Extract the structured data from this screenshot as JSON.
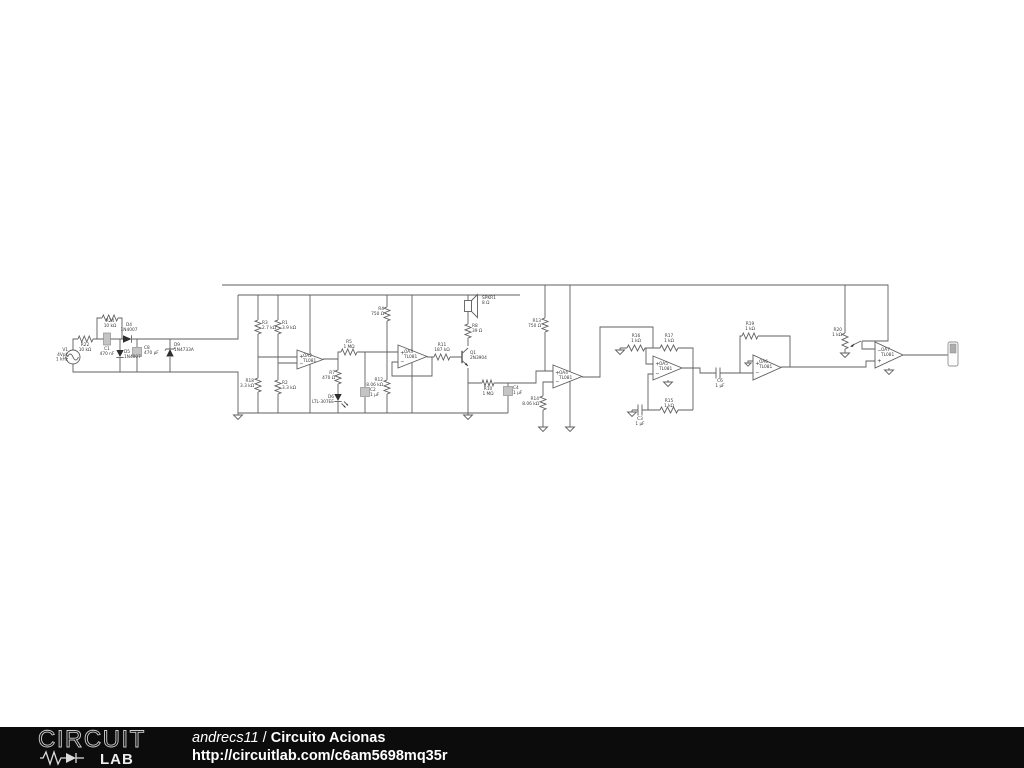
{
  "footer": {
    "logo_word1": "CIRCUIT",
    "logo_word2": "LAB",
    "user": "andrecs11",
    "separator": " / ",
    "title": "Circuito Acionas",
    "url": "http://circuitlab.com/c6am5698mq35r",
    "bar_color": "#0c0c0c",
    "text_color": "#ffffff"
  },
  "schematic": {
    "colors": {
      "wire": "#5f5f5f",
      "dark": "#2e2e2e",
      "ecap_fill": "#c4c4c4",
      "ecap_stroke": "#8f8f8f",
      "label": "#3a3a3a"
    },
    "labels": [
      {
        "name": "V1",
        "x": 68,
        "y": 351,
        "anchor": "end",
        "lines": [
          "V1",
          "4Vpk",
          "1 kHz"
        ]
      },
      {
        "name": "R22",
        "x": 85,
        "y": 346,
        "anchor": "middle",
        "lines": [
          "R22",
          "10 kΩ"
        ]
      },
      {
        "name": "R24",
        "x": 110,
        "y": 322,
        "anchor": "middle",
        "lines": [
          "R24",
          "10 kΩ"
        ]
      },
      {
        "name": "C1",
        "x": 107,
        "y": 350,
        "anchor": "middle",
        "lines": [
          "C1",
          "470 nF"
        ]
      },
      {
        "name": "D4",
        "x": 129,
        "y": 326,
        "anchor": "middle",
        "lines": [
          "D4",
          "1N4007"
        ]
      },
      {
        "name": "D5",
        "x": 124,
        "y": 353,
        "anchor": "start",
        "lines": [
          "D5",
          "1N4007"
        ]
      },
      {
        "name": "C8",
        "x": 144,
        "y": 349,
        "anchor": "start",
        "lines": [
          "C8",
          "470 µF"
        ]
      },
      {
        "name": "D9",
        "x": 174,
        "y": 346,
        "anchor": "start",
        "lines": [
          "D9",
          "1N4733A"
        ]
      },
      {
        "name": "R3",
        "x": 262,
        "y": 324,
        "anchor": "start",
        "lines": [
          "R3",
          "2.7 kΩ"
        ]
      },
      {
        "name": "R18",
        "x": 254,
        "y": 382,
        "anchor": "end",
        "lines": [
          "R18",
          "3.3 kΩ"
        ]
      },
      {
        "name": "R1",
        "x": 282,
        "y": 324,
        "anchor": "start",
        "lines": [
          "R1",
          "3.9 kΩ"
        ]
      },
      {
        "name": "R2",
        "x": 282,
        "y": 384,
        "anchor": "start",
        "lines": [
          "R2",
          "3.3 kΩ"
        ]
      },
      {
        "name": "OA2",
        "x": 303,
        "y": 357,
        "anchor": "start",
        "lines": [
          "OA2",
          "TL081"
        ]
      },
      {
        "name": "R5",
        "x": 349,
        "y": 343,
        "anchor": "middle",
        "lines": [
          "R5",
          "1 MΩ"
        ]
      },
      {
        "name": "R7",
        "x": 335,
        "y": 374,
        "anchor": "end",
        "lines": [
          "R7",
          "470 Ω"
        ]
      },
      {
        "name": "D6",
        "x": 334,
        "y": 398,
        "anchor": "end",
        "lines": [
          "D6",
          "LTL-307EE"
        ]
      },
      {
        "name": "R4",
        "x": 384,
        "y": 310,
        "anchor": "end",
        "lines": [
          "R4",
          "750 Ω"
        ]
      },
      {
        "name": "C2",
        "x": 370,
        "y": 391,
        "anchor": "start",
        "lines": [
          "C2",
          "1 µF"
        ]
      },
      {
        "name": "R12",
        "x": 383,
        "y": 381,
        "anchor": "end",
        "lines": [
          "R12",
          "8.06 kΩ"
        ]
      },
      {
        "name": "OA3",
        "x": 404,
        "y": 353,
        "anchor": "start",
        "lines": [
          "OA3",
          "TL081"
        ]
      },
      {
        "name": "R11",
        "x": 442,
        "y": 346,
        "anchor": "middle",
        "lines": [
          "R11",
          "187 kΩ"
        ]
      },
      {
        "name": "Q1",
        "x": 470,
        "y": 354,
        "anchor": "start",
        "lines": [
          "Q1",
          "2N3904"
        ]
      },
      {
        "name": "R8",
        "x": 472,
        "y": 327,
        "anchor": "start",
        "lines": [
          "R8",
          "39 Ω"
        ]
      },
      {
        "name": "SPKR1",
        "x": 482,
        "y": 299,
        "anchor": "start",
        "lines": [
          "SPKR1",
          "8 Ω"
        ]
      },
      {
        "name": "R10",
        "x": 488,
        "y": 390,
        "anchor": "middle",
        "lines": [
          "R10",
          "1 MΩ"
        ]
      },
      {
        "name": "C4",
        "x": 513,
        "y": 389,
        "anchor": "start",
        "lines": [
          "C4",
          "1 µF"
        ]
      },
      {
        "name": "R13",
        "x": 541,
        "y": 322,
        "anchor": "end",
        "lines": [
          "R13",
          "750 Ω"
        ]
      },
      {
        "name": "R14",
        "x": 539,
        "y": 400,
        "anchor": "end",
        "lines": [
          "R14",
          "8.06 kΩ"
        ]
      },
      {
        "name": "OA4",
        "x": 559,
        "y": 374,
        "anchor": "start",
        "lines": [
          "OA4",
          "TL081"
        ]
      },
      {
        "name": "R16",
        "x": 636,
        "y": 337,
        "anchor": "middle",
        "lines": [
          "R16",
          "1 kΩ"
        ]
      },
      {
        "name": "R17",
        "x": 669,
        "y": 337,
        "anchor": "middle",
        "lines": [
          "R17",
          "1 kΩ"
        ]
      },
      {
        "name": "OA5",
        "x": 659,
        "y": 365,
        "anchor": "start",
        "lines": [
          "OA5",
          "TL081"
        ]
      },
      {
        "name": "C3",
        "x": 640,
        "y": 420,
        "anchor": "middle",
        "lines": [
          "C3",
          "1 µF"
        ]
      },
      {
        "name": "R15",
        "x": 669,
        "y": 402,
        "anchor": "middle",
        "lines": [
          "R15",
          "1 kΩ"
        ]
      },
      {
        "name": "R19",
        "x": 750,
        "y": 325,
        "anchor": "middle",
        "lines": [
          "R19",
          "1 kΩ"
        ]
      },
      {
        "name": "C6",
        "x": 720,
        "y": 382,
        "anchor": "middle",
        "lines": [
          "C6",
          "1 µF"
        ]
      },
      {
        "name": "OA6",
        "x": 759,
        "y": 363,
        "anchor": "start",
        "lines": [
          "OA6",
          "TL081"
        ]
      },
      {
        "name": "R20",
        "x": 842,
        "y": 331,
        "anchor": "end",
        "lines": [
          "R20",
          "1 kΩ"
        ]
      },
      {
        "name": "OA7",
        "x": 881,
        "y": 351,
        "anchor": "start",
        "lines": [
          "OA7",
          "TL081"
        ]
      }
    ],
    "parts": [
      {
        "name": "V1",
        "type": "vsource",
        "x": 73,
        "y": 357,
        "r": 7
      },
      {
        "name": "R22",
        "type": "res-h",
        "x": 78,
        "y": 339,
        "len": 15
      },
      {
        "name": "R24",
        "type": "res-h",
        "x": 102,
        "y": 318,
        "len": 16
      },
      {
        "name": "C1",
        "type": "ecap",
        "x": 107,
        "y": 339,
        "w": 7,
        "h": 12
      },
      {
        "name": "D4",
        "type": "diode-r",
        "x": 123,
        "y": 339
      },
      {
        "name": "D5",
        "type": "diode-d",
        "x": 120,
        "y": 350
      },
      {
        "name": "C8",
        "type": "ecap",
        "x": 137,
        "y": 352,
        "w": 9,
        "h": 9
      },
      {
        "name": "D9",
        "type": "zener-u",
        "x": 170,
        "y": 349
      },
      {
        "name": "R3",
        "type": "res-v",
        "x": 258,
        "y": 320,
        "len": 14
      },
      {
        "name": "R18",
        "type": "res-v",
        "x": 258,
        "y": 378,
        "len": 14
      },
      {
        "name": "R1",
        "type": "res-v",
        "x": 278,
        "y": 320,
        "len": 14
      },
      {
        "name": "R2",
        "type": "res-v",
        "x": 278,
        "y": 380,
        "len": 14
      },
      {
        "name": "OA2",
        "type": "opamp",
        "x": 297,
        "y": 350,
        "w": 26,
        "h": 19,
        "plusTop": true
      },
      {
        "name": "R5",
        "type": "res-h",
        "x": 341,
        "y": 352,
        "len": 16
      },
      {
        "name": "R7",
        "type": "res-v",
        "x": 338,
        "y": 370,
        "len": 14
      },
      {
        "name": "D6",
        "type": "led-d",
        "x": 338,
        "y": 394
      },
      {
        "name": "R4",
        "type": "res-v",
        "x": 387,
        "y": 307,
        "len": 14
      },
      {
        "name": "C2",
        "type": "ecap",
        "x": 365,
        "y": 392,
        "w": 9,
        "h": 9
      },
      {
        "name": "R12",
        "type": "res-v",
        "x": 387,
        "y": 380,
        "len": 14
      },
      {
        "name": "OA3",
        "type": "opamp",
        "x": 398,
        "y": 345,
        "w": 29,
        "h": 23,
        "plusTop": true
      },
      {
        "name": "R11",
        "type": "res-h",
        "x": 434,
        "y": 357,
        "len": 16
      },
      {
        "name": "Q1",
        "type": "npn",
        "x": 462,
        "y": 357
      },
      {
        "name": "R8",
        "type": "res-v",
        "x": 468,
        "y": 324,
        "len": 14
      },
      {
        "name": "SPKR1",
        "type": "speaker",
        "x": 468,
        "y": 306
      },
      {
        "name": "R10",
        "type": "res-h",
        "x": 482,
        "y": 383,
        "len": 12
      },
      {
        "name": "C4",
        "type": "ecap",
        "x": 508,
        "y": 391,
        "w": 9,
        "h": 9
      },
      {
        "name": "R13",
        "type": "res-v",
        "x": 545,
        "y": 318,
        "len": 14
      },
      {
        "name": "R14",
        "type": "res-v",
        "x": 543,
        "y": 396,
        "len": 14
      },
      {
        "name": "OA4",
        "type": "opamp",
        "x": 553,
        "y": 365,
        "w": 29,
        "h": 23,
        "plusTop": true
      },
      {
        "name": "R16",
        "type": "res-h",
        "x": 627,
        "y": 348,
        "len": 18
      },
      {
        "name": "R17",
        "type": "res-h",
        "x": 660,
        "y": 348,
        "len": 18
      },
      {
        "name": "OA5",
        "type": "opamp",
        "x": 653,
        "y": 356,
        "w": 29,
        "h": 24,
        "plusTop": true
      },
      {
        "name": "C3",
        "type": "pcap-h",
        "x": 638,
        "y": 410
      },
      {
        "name": "R15",
        "type": "res-h",
        "x": 660,
        "y": 410,
        "len": 18
      },
      {
        "name": "R19",
        "type": "res-h",
        "x": 742,
        "y": 336,
        "len": 16
      },
      {
        "name": "C6",
        "type": "pcap-h",
        "x": 716,
        "y": 373
      },
      {
        "name": "OA6",
        "type": "opamp",
        "x": 753,
        "y": 355,
        "w": 28,
        "h": 25,
        "plusTop": true
      },
      {
        "name": "R20",
        "type": "pot-v",
        "x": 845,
        "y": 333,
        "len": 16
      },
      {
        "name": "R20-wiper",
        "type": "wiper",
        "x1": 861,
        "y1": 341,
        "x2": 851,
        "y2": 346
      },
      {
        "name": "OA7",
        "type": "opamp",
        "x": 875,
        "y": 342,
        "w": 28,
        "h": 26,
        "plusTop": false
      },
      {
        "name": "OUT1",
        "type": "probe",
        "x": 948,
        "y": 342
      },
      {
        "name": "GND1",
        "type": "gnd",
        "x": 238,
        "y": 415
      },
      {
        "name": "GND2",
        "type": "gnd",
        "x": 468,
        "y": 415
      },
      {
        "name": "GND3",
        "type": "gnd",
        "x": 543,
        "y": 427
      },
      {
        "name": "GND4",
        "type": "gnd",
        "x": 570,
        "y": 427
      },
      {
        "name": "GND5",
        "type": "gnd",
        "x": 620,
        "y": 350
      },
      {
        "name": "GND6",
        "type": "gnd",
        "x": 632,
        "y": 412
      },
      {
        "name": "GND7",
        "type": "gnd",
        "x": 668,
        "y": 382
      },
      {
        "name": "GND8",
        "type": "gnd",
        "x": 748,
        "y": 363,
        "s": 0.7
      },
      {
        "name": "GND9",
        "type": "gnd",
        "x": 845,
        "y": 353
      },
      {
        "name": "GND10",
        "type": "gnd",
        "x": 889,
        "y": 370
      }
    ]
  }
}
